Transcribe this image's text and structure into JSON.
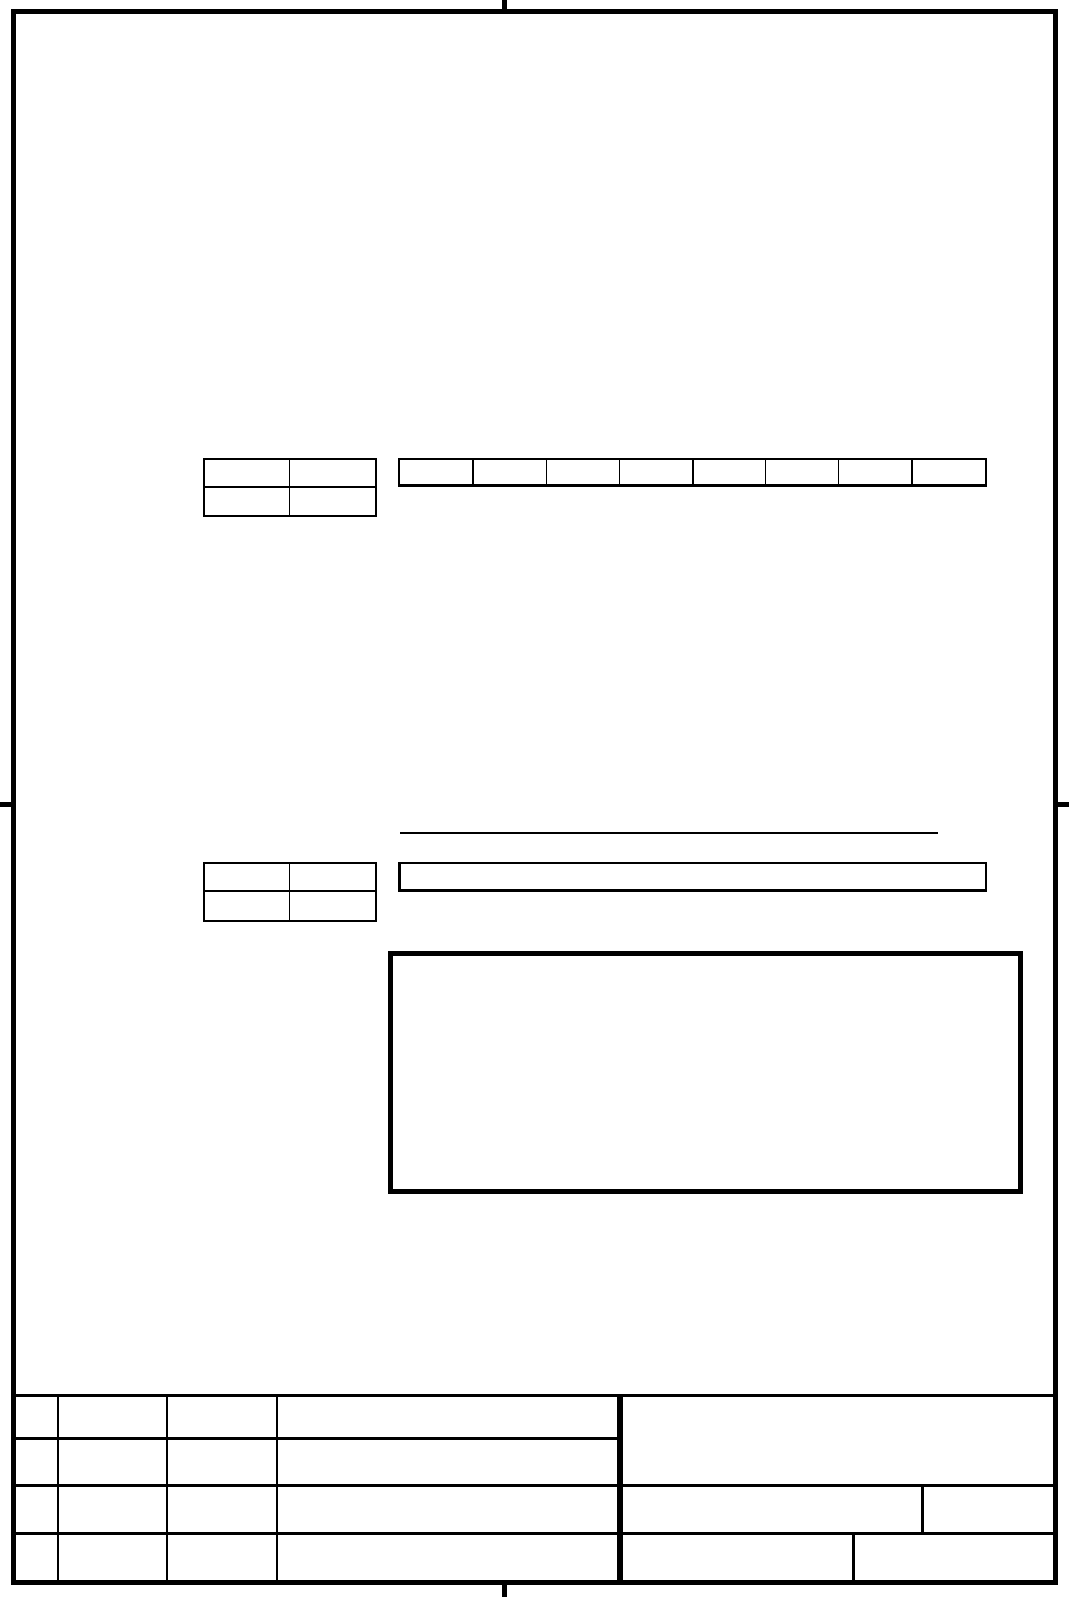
{
  "page": {
    "background_color": "#ffffff",
    "line_color": "#000000"
  },
  "upper_section": {
    "label_table": {
      "rows": [
        [
          "",
          ""
        ],
        [
          "",
          ""
        ]
      ]
    },
    "field_strip": {
      "cells": [
        "",
        "",
        "",
        "",
        "",
        "",
        "",
        ""
      ]
    }
  },
  "middle_section": {
    "underline_text": "",
    "label_table": {
      "rows": [
        [
          "",
          ""
        ],
        [
          "",
          ""
        ]
      ]
    },
    "entry_box": ""
  },
  "figure_box": {
    "content": ""
  },
  "title_block": {
    "left_table": {
      "rows": [
        [
          "",
          "",
          "",
          ""
        ],
        [
          "",
          "",
          "",
          ""
        ],
        [
          "",
          "",
          "",
          ""
        ],
        [
          "",
          "",
          "",
          ""
        ]
      ]
    },
    "right_section": {
      "main_cell": "",
      "row3_cells": [
        "",
        ""
      ],
      "row4_cells": [
        "",
        ""
      ]
    }
  }
}
